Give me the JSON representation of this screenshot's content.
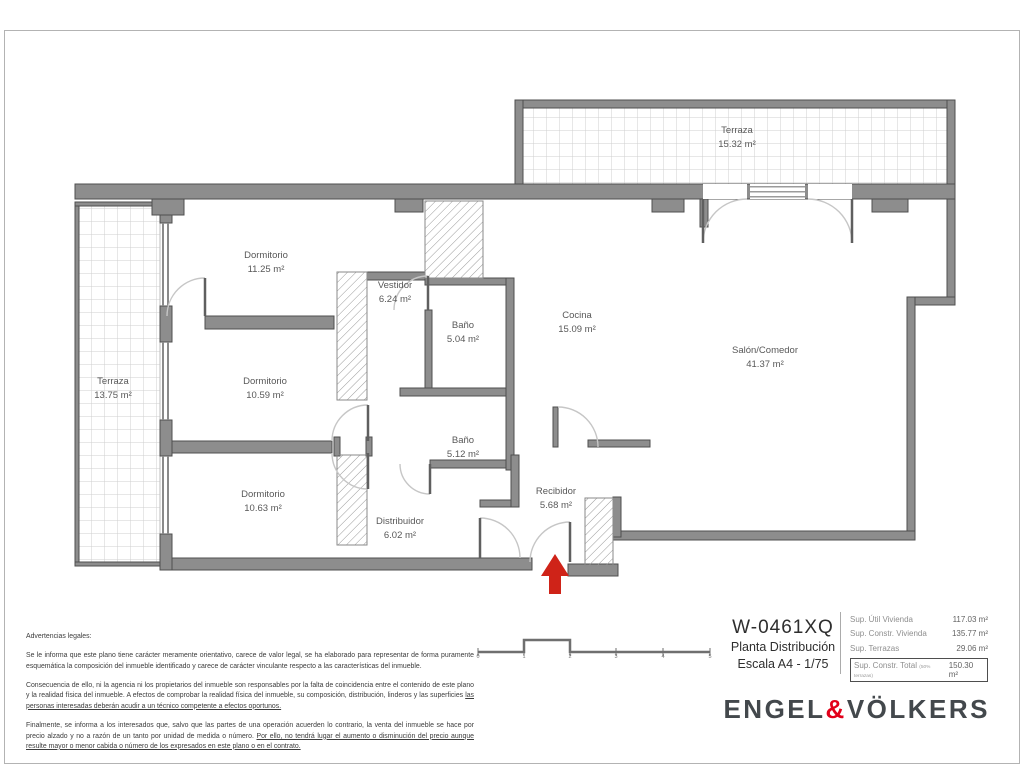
{
  "plan": {
    "rooms": [
      {
        "name": "Terraza",
        "area": "15.32 m²"
      },
      {
        "name": "Dormitorio",
        "area": "11.25 m²"
      },
      {
        "name": "Vestidor",
        "area": "6.24 m²"
      },
      {
        "name": "Baño",
        "area": "5.04 m²"
      },
      {
        "name": "Cocina",
        "area": "15.09 m²"
      },
      {
        "name": "Salón/Comedor",
        "area": "41.37 m²"
      },
      {
        "name": "Terraza",
        "area": "13.75 m²"
      },
      {
        "name": "Dormitorio",
        "area": "10.59 m²"
      },
      {
        "name": "Baño",
        "area": "5.12 m²"
      },
      {
        "name": "Dormitorio",
        "area": "10.63 m²"
      },
      {
        "name": "Recibidor",
        "area": "5.68 m²"
      },
      {
        "name": "Distribuidor",
        "area": "6.02 m²"
      }
    ]
  },
  "legal": {
    "title": "Advertencias legales:",
    "p1": "Se le informa que este plano tiene carácter meramente orientativo, carece de valor legal, se ha elaborado para representar de forma puramente esquemática la composición del inmueble identificado y carece de carácter vinculante respecto a las características del inmueble.",
    "p2a": "Consecuencia de ello, ni la agencia ni los propietarios del inmueble son responsables por la falta de coincidencia entre el contenido de este plano y la realidad física del inmueble. A efectos de comprobar la realidad física del inmueble, su composición, distribución, linderos y las superficies ",
    "p2b": "las personas interesadas deberán acudir a un técnico competente a efectos oportunos.",
    "p3a": "Finalmente, se informa a los interesados que, salvo que las partes de una operación acuerden lo contrario, la venta del inmueble se hace por precio alzado y no a razón de un tanto por unidad de medida o número. ",
    "p3b": "Por ello, no tendrá lugar el aumento o disminución del precio aunque resulte mayor o menor cabida o número de los expresados en este plano o en el contrato."
  },
  "scalebar": {
    "ticks": [
      "0",
      "1",
      "2",
      "3",
      "4",
      "5"
    ]
  },
  "info": {
    "reference": "W-0461XQ",
    "plan_name": "Planta Distribución",
    "scale": "Escala A4 - 1/75"
  },
  "surfaces": {
    "rows": [
      {
        "label": "Sup. Útil Vivienda",
        "value": "117.03 m²"
      },
      {
        "label": "Sup. Constr. Vivienda",
        "value": "135.77 m²"
      },
      {
        "label": "Sup. Terrazas",
        "value": "29.06 m²"
      }
    ],
    "total": {
      "label": "Sup. Constr. Total",
      "note": "(50% terrazas)",
      "value": "150.30 m²"
    }
  },
  "brand": {
    "left": "ENGEL",
    "amp": "&",
    "right": "VÖLKERS"
  },
  "colors": {
    "wall": "#8d8d8d",
    "entrance_arrow": "#cf2318",
    "brand_red": "#e2001a"
  }
}
